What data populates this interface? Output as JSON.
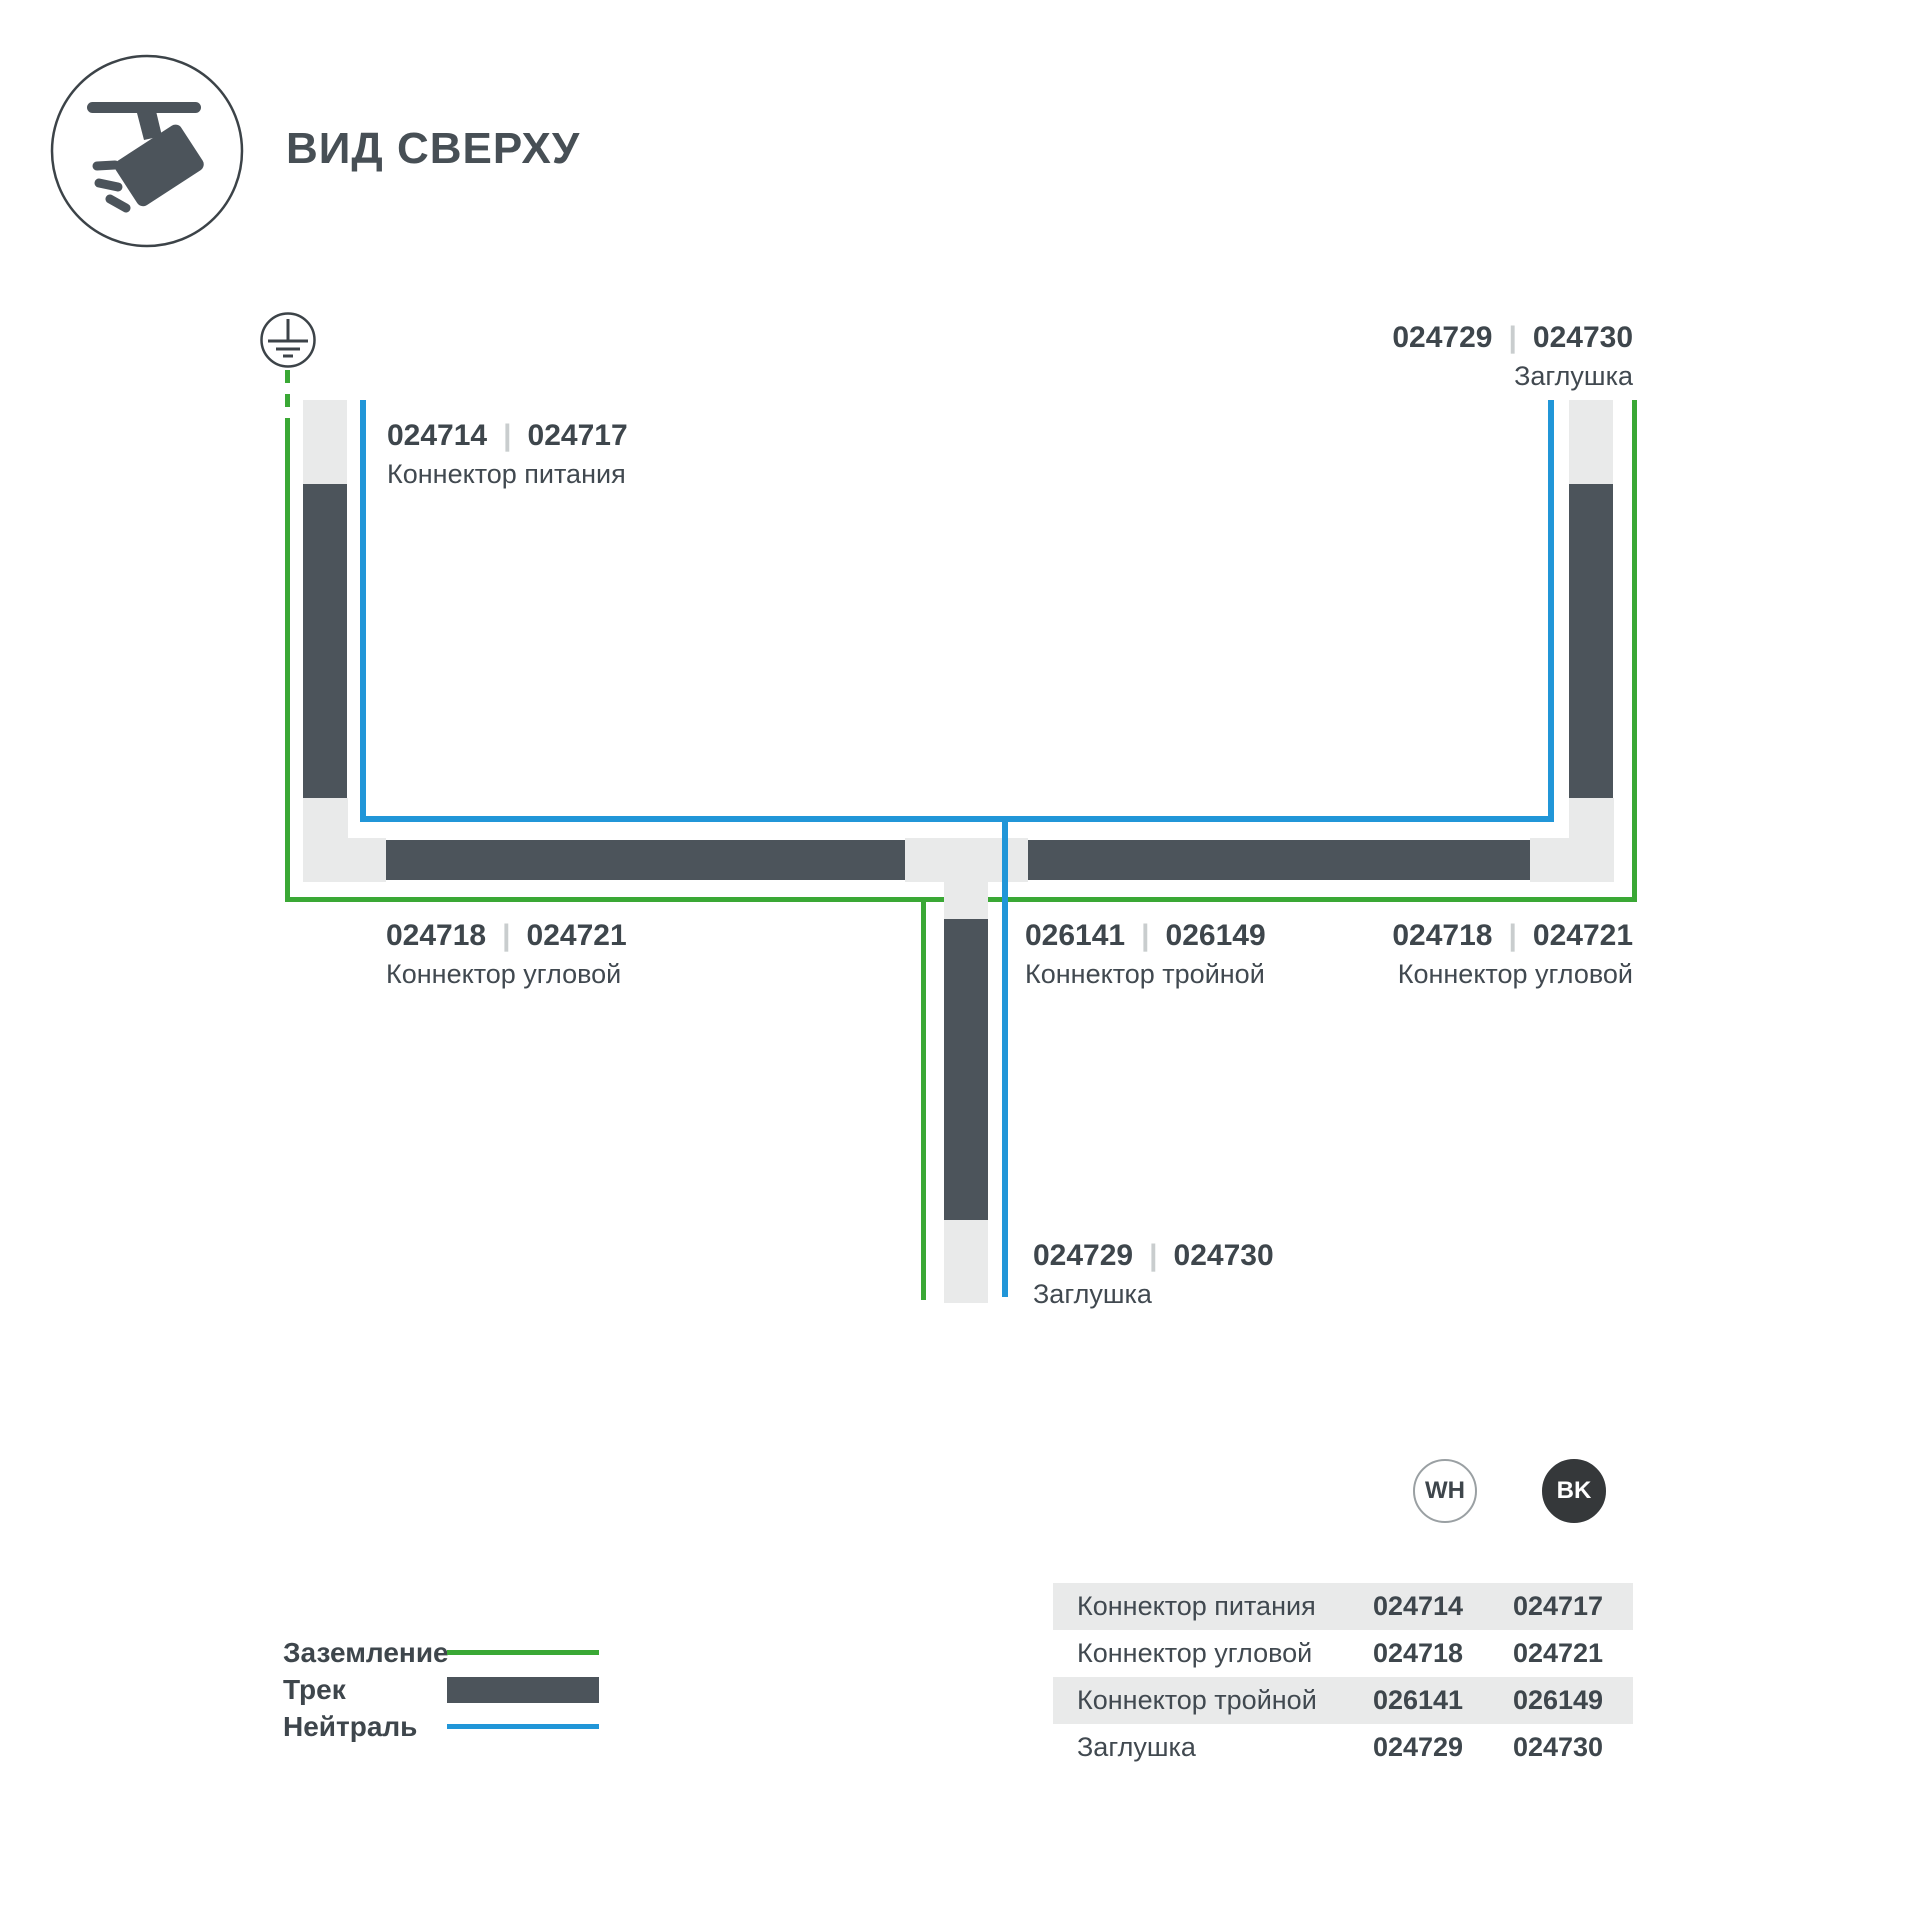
{
  "header": {
    "title": "ВИД СВЕРХУ"
  },
  "colors": {
    "ground_green": "#3aa835",
    "neutral_blue": "#2196d8",
    "track_dark": "#4c545b",
    "connector_gray": "#e9eaea"
  },
  "diagram": {
    "separator": "|",
    "labels": {
      "power": {
        "code_wh": "024714",
        "code_bk": "024717",
        "name": "Коннектор питания"
      },
      "cap_top_right": {
        "code_wh": "024729",
        "code_bk": "024730",
        "name": "Заглушка"
      },
      "corner_left": {
        "code_wh": "024718",
        "code_bk": "024721",
        "name": "Коннектор угловой"
      },
      "tee": {
        "code_wh": "026141",
        "code_bk": "026149",
        "name": "Коннектор тройной"
      },
      "corner_right": {
        "code_wh": "024718",
        "code_bk": "024721",
        "name": "Коннектор угловой"
      },
      "cap_bottom": {
        "code_wh": "024729",
        "code_bk": "024730",
        "name": "Заглушка"
      }
    }
  },
  "legend": {
    "ground": "Заземление",
    "track": "Трек",
    "neutral": "Нейтраль"
  },
  "variants": {
    "white": "WH",
    "black": "BK"
  },
  "table": {
    "rows": [
      {
        "name": "Коннектор питания",
        "wh": "024714",
        "bk": "024717"
      },
      {
        "name": "Коннектор угловой",
        "wh": "024718",
        "bk": "024721"
      },
      {
        "name": "Коннектор тройной",
        "wh": "026141",
        "bk": "026149"
      },
      {
        "name": "Заглушка",
        "wh": "024729",
        "bk": "024730"
      }
    ]
  }
}
